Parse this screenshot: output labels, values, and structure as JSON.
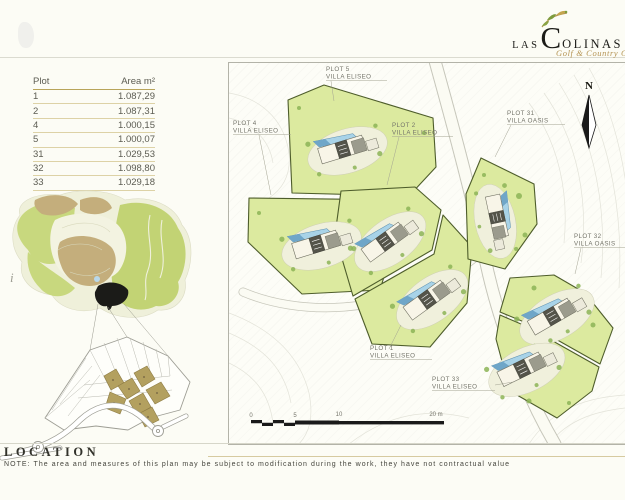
{
  "header": {
    "brand": {
      "las": "LAS",
      "c": "C",
      "olinas": "OLINAS",
      "sub": "Golf & Country Club"
    }
  },
  "table": {
    "headers": [
      "Plot",
      "Area m²"
    ],
    "rows": [
      [
        "1",
        "1.087,29"
      ],
      [
        "2",
        "1.087,31"
      ],
      [
        "4",
        "1.000,15"
      ],
      [
        "5",
        "1.000,07"
      ],
      [
        "31",
        "1.029,53"
      ],
      [
        "32",
        "1.098,80"
      ],
      [
        "33",
        "1.029,18"
      ]
    ]
  },
  "plan": {
    "north": "N",
    "labels": [
      {
        "line1": "PLOT 5",
        "line2": "VILLA ELISEO"
      },
      {
        "line1": "PLOT 4",
        "line2": "VILLA ELISEO"
      },
      {
        "line1": "PLOT 2",
        "line2": "VILLA ELISEO"
      },
      {
        "line1": "PLOT 31",
        "line2": "VILLA OASIS"
      },
      {
        "line1": "PLOT 32",
        "line2": "VILLA OASIS"
      },
      {
        "line1": "PLOT 1",
        "line2": "VILLA ELISEO"
      },
      {
        "line1": "PLOT 33",
        "line2": "VILLA ELISEO"
      }
    ],
    "scale": {
      "t0": "0",
      "t5": "5",
      "t10": "10",
      "t20": "20 m"
    }
  },
  "location_map": {
    "marker": "i"
  },
  "footer": {
    "title": "LOCATION",
    "note": "NOTE: The area and measures of this plan may be subject to modification during the work, they have not contractual value"
  },
  "colors": {
    "accent_gold": "#b49352",
    "plot_green": "#dcea9f",
    "plot_border": "#4e5d2b",
    "pool_blue": "#a8d3e8",
    "marker_black": "#1b1b18",
    "table_line": "#ddd2a6"
  }
}
